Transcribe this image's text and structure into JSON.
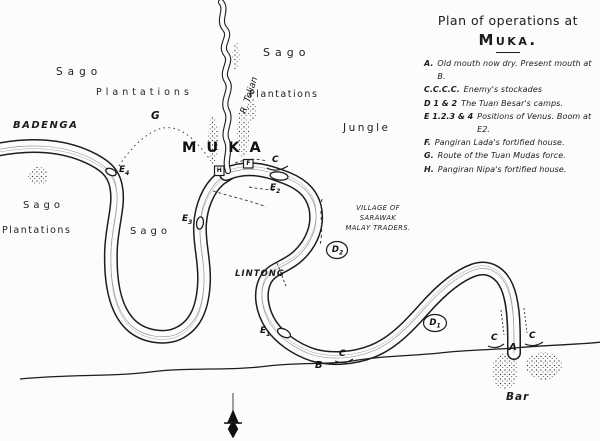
{
  "title": {
    "line1": "Plan of operations at",
    "line2": "Muka."
  },
  "legend": {
    "items": [
      {
        "key": "A.",
        "text": "Old mouth now dry. Present mouth at B."
      },
      {
        "key": "C.C.C.C.",
        "text": "Enemy's stockades"
      },
      {
        "key": "D 1 & 2",
        "text": "The Tuan Besar's camps."
      },
      {
        "key": "E 1.2.3 & 4",
        "text": "Positions of Venus. Boom at E2."
      },
      {
        "key": "F.",
        "text": "Pangiran Lada's fortified house."
      },
      {
        "key": "G.",
        "text": "Route of the Tuan Mudas force."
      },
      {
        "key": "H.",
        "text": "Pangiran Nipa's fortified house."
      }
    ]
  },
  "map_labels": {
    "sago_nw": "Sago",
    "plantations_nw": "Plantations",
    "badenga": "Badenga",
    "g_route": "G",
    "river_telian": "R. Telian",
    "sago_ne": "Sago",
    "plantations_ne": "Plantations",
    "jungle": "Jungle",
    "muka": "Muka",
    "sago_w": "Sago",
    "plantations_w": "Plantations",
    "sago_c": "Sago",
    "village_line1": "Village of",
    "village_line2": "Sarawak",
    "village_line3": "Malay Traders.",
    "lintong": "Lintong",
    "bar": "Bar"
  },
  "markers": {
    "a": "A",
    "b": "B",
    "c": "C",
    "f": "F",
    "h": "H",
    "d1": {
      "letter": "D",
      "sub": "1"
    },
    "d2": {
      "letter": "D",
      "sub": "2"
    },
    "e1": {
      "letter": "E",
      "sub": "1"
    },
    "e2": {
      "letter": "E",
      "sub": "2"
    },
    "e3": {
      "letter": "E",
      "sub": "3"
    },
    "e4": {
      "letter": "E",
      "sub": "4"
    }
  },
  "colors": {
    "ink": "#1d1d1d",
    "paper": "#fcfcfa"
  }
}
